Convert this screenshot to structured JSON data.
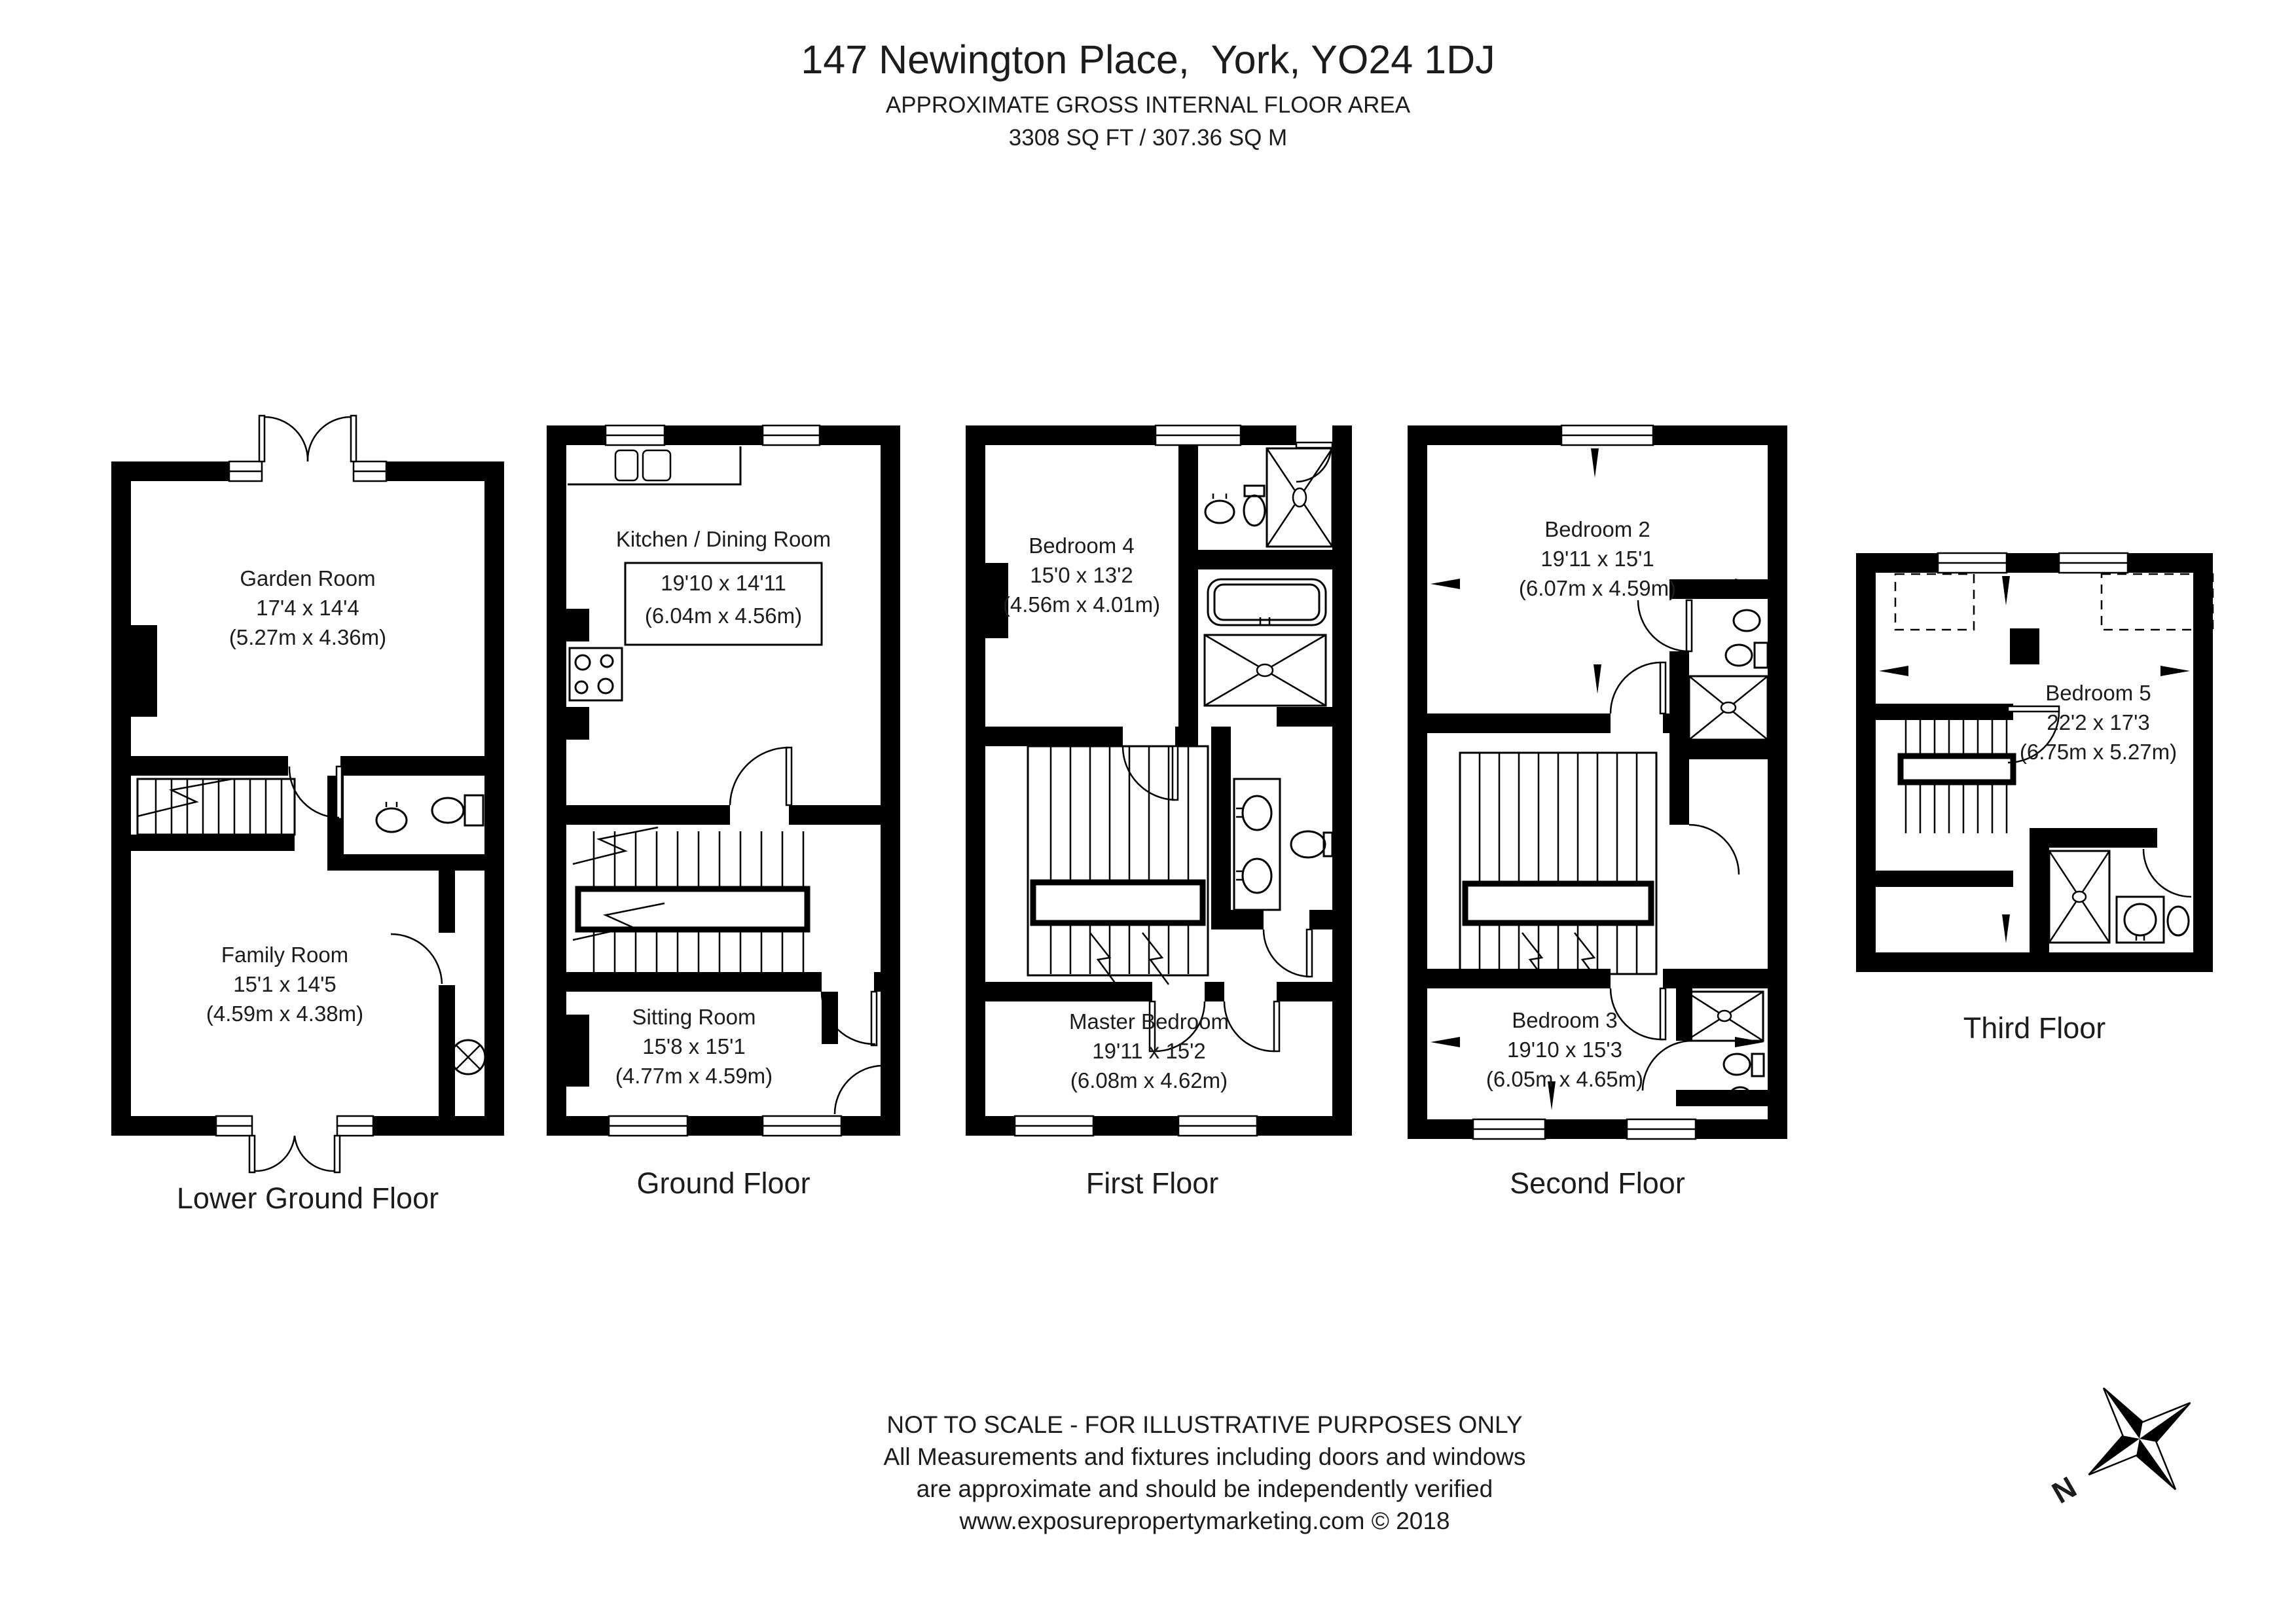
{
  "header": {
    "title": "147 Newington Place,  York, YO24 1DJ",
    "subtitle": "APPROXIMATE GROSS INTERNAL FLOOR AREA",
    "area": "3308 SQ FT / 307.36 SQ M"
  },
  "floors": [
    {
      "name": "Lower Ground Floor",
      "rooms": [
        {
          "name": "Garden Room",
          "imperial": "17'4 x 14'4",
          "metric": "(5.27m x 4.36m)"
        },
        {
          "name": "Family Room",
          "imperial": "15'1 x 14'5",
          "metric": "(4.59m x 4.38m)"
        }
      ]
    },
    {
      "name": "Ground Floor",
      "rooms": [
        {
          "name": "Kitchen / Dining Room",
          "imperial": "19'10 x 14'11",
          "metric": "(6.04m x 4.56m)"
        },
        {
          "name": "Sitting Room",
          "imperial": "15'8 x 15'1",
          "metric": "(4.77m x 4.59m)"
        }
      ]
    },
    {
      "name": "First Floor",
      "rooms": [
        {
          "name": "Bedroom 4",
          "imperial": "15'0 x 13'2",
          "metric": "(4.56m x 4.01m)"
        },
        {
          "name": "Master Bedroom",
          "imperial": "19'11 x 15'2",
          "metric": "(6.08m x 4.62m)"
        }
      ]
    },
    {
      "name": "Second Floor",
      "rooms": [
        {
          "name": "Bedroom 2",
          "imperial": "19'11 x 15'1",
          "metric": "(6.07m x 4.59m)"
        },
        {
          "name": "Bedroom 3",
          "imperial": "19'10 x 15'3",
          "metric": "(6.05m x 4.65m)"
        }
      ]
    },
    {
      "name": "Third Floor",
      "rooms": [
        {
          "name": "Bedroom 5",
          "imperial": "22'2 x 17'3",
          "metric": "(6.75m x 5.27m)"
        }
      ]
    }
  ],
  "disclaimer": {
    "line1": "NOT TO SCALE - FOR ILLUSTRATIVE PURPOSES ONLY",
    "line2": "All Measurements and fixtures including doors and windows",
    "line3": "are approximate and should be independently verified",
    "line4": "www.exposurepropertymarketing.com © 2018"
  },
  "compass": {
    "north_label": "N"
  },
  "colors": {
    "wall": "#000000",
    "background": "#ffffff",
    "text": "#1c1c1c"
  }
}
